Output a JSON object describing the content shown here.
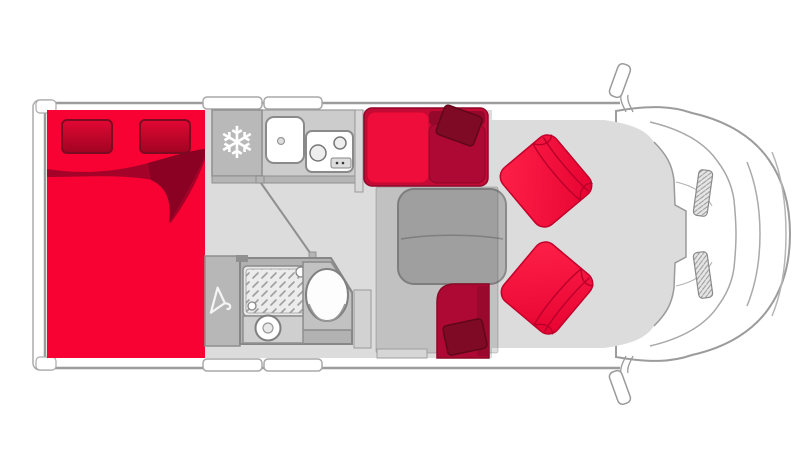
{
  "meta": {
    "title": "Motorhome floor plan - overhead view",
    "view": "top-down layout diagram",
    "vehicle": "coachbuilt camper van"
  },
  "icons": {
    "snowflake": "❄",
    "hanger": "clothes-hanger-outline"
  },
  "palette": {
    "white": "#ffffff",
    "outline": "#9c9c9c",
    "floor_gray": "#dcdcdd",
    "wall_gray": "#b5b5b5",
    "counter_gray": "#cccccc",
    "fridge_gray": "#b9b9b9",
    "bathroom_gray": "#b2b2b2",
    "table_gray": "#b3b3b3",
    "overlay": "rgba(70,70,70,0.18)",
    "bed_red": "#f80233",
    "blanket_red": "#a40229",
    "blanket_shadow": "#8a0124",
    "pillow_dark_red": "#7e0a26",
    "sofa_dark_red": "#ad0934",
    "sofa_bright_red": "#ee0d3b",
    "seat_bright_red": "#f5113a",
    "seat_line_red": "#b80029"
  },
  "fixtures": {
    "bed": "double-bed",
    "pillows": "bed-pillows",
    "blanket": "folded-blanket",
    "fridge": "refrigerator",
    "sink": "kitchen-sink",
    "hob": "two-burner-hob",
    "kitchen": "kitchen-counter",
    "wardrobe": "wardrobe",
    "shower": "shower-tray",
    "toilet": "toilet",
    "washbasin": "washbasin",
    "table": "dinette-table",
    "sofa": "dinette-bench-sofa",
    "side_seat": "side-bench-seat",
    "cab_seats": "swivel-cab-seats",
    "cab": "driver-cab",
    "mirrors": "wing-mirrors",
    "overlay_zone": "drop-down-bed-zone",
    "entry_step": "entrance-step"
  }
}
